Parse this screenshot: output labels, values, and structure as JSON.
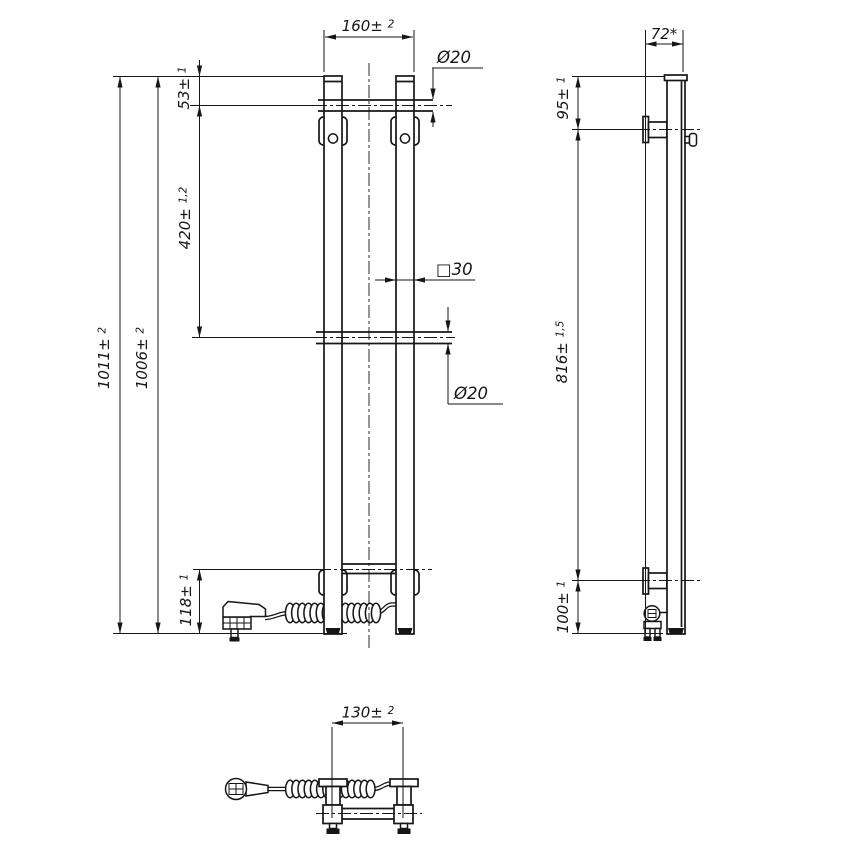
{
  "drawing": {
    "front_view": {
      "overall_width": {
        "base": "160± ",
        "tol": "2"
      },
      "total_height": {
        "base": "1011± ",
        "tol": "2"
      },
      "secondary_height": {
        "base": "1006± ",
        "tol": "2"
      },
      "top_tube_offset": {
        "base": "53± ",
        "tol": "1"
      },
      "tube_spacing": {
        "base": "420± ",
        "tol": "1,2"
      },
      "bottom_tube_offset": {
        "base": "118± ",
        "tol": "1"
      },
      "top_tube_diameter": "Ø20",
      "post_profile": "□30",
      "middle_tube_diameter": "Ø20"
    },
    "side_view": {
      "depth": "72*",
      "top_bracket_offset": {
        "base": "95± ",
        "tol": "1"
      },
      "bracket_spacing": {
        "base": "816± ",
        "tol": "1,5"
      },
      "bottom_bracket_offset": {
        "base": "100± ",
        "tol": "1"
      }
    },
    "plan_view": {
      "bracket_spacing": {
        "base": "130± ",
        "tol": "2"
      }
    }
  }
}
